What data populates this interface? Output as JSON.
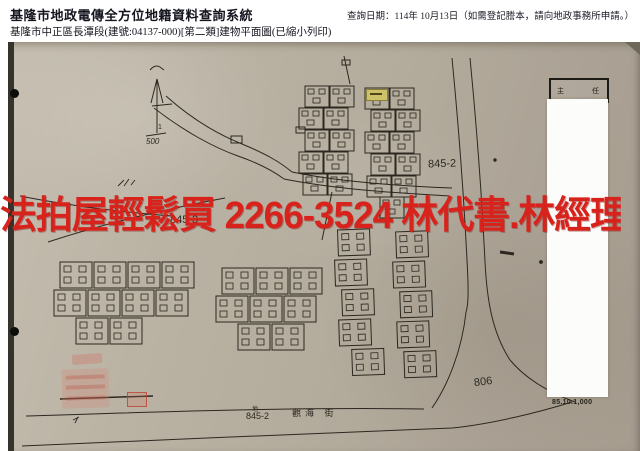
{
  "header": {
    "system_title": "基隆市地政電傳全方位地籍資料查詢系統",
    "query_date": "查詢日期：114年 10月13日（如需登記謄本，請向地政事務所申請。）",
    "subtitle": "基隆市中正區長潭段(建號:04137-000)[第二類]建物平面圖(已縮小列印)"
  },
  "watermark": {
    "text": "法拍屋輕鬆買 2266-3524 林代書.林經理",
    "color": "#d8231c"
  },
  "map": {
    "paper_color": "#b7af9f",
    "ink_color": "#2c2820",
    "scale_numerator": "1",
    "scale_denominator": "500",
    "labels": {
      "parcel_mid_right": "845-2",
      "parcel_under_watermark": "845-3",
      "parcel_bottom_right": "806",
      "parcel_bottom_left_prefix": "地",
      "parcel_bottom_left": "845-2",
      "street_bottom": "觀海 街",
      "signature_left": "主",
      "signature_right": "任",
      "print_code": "85.10.1,000"
    }
  }
}
